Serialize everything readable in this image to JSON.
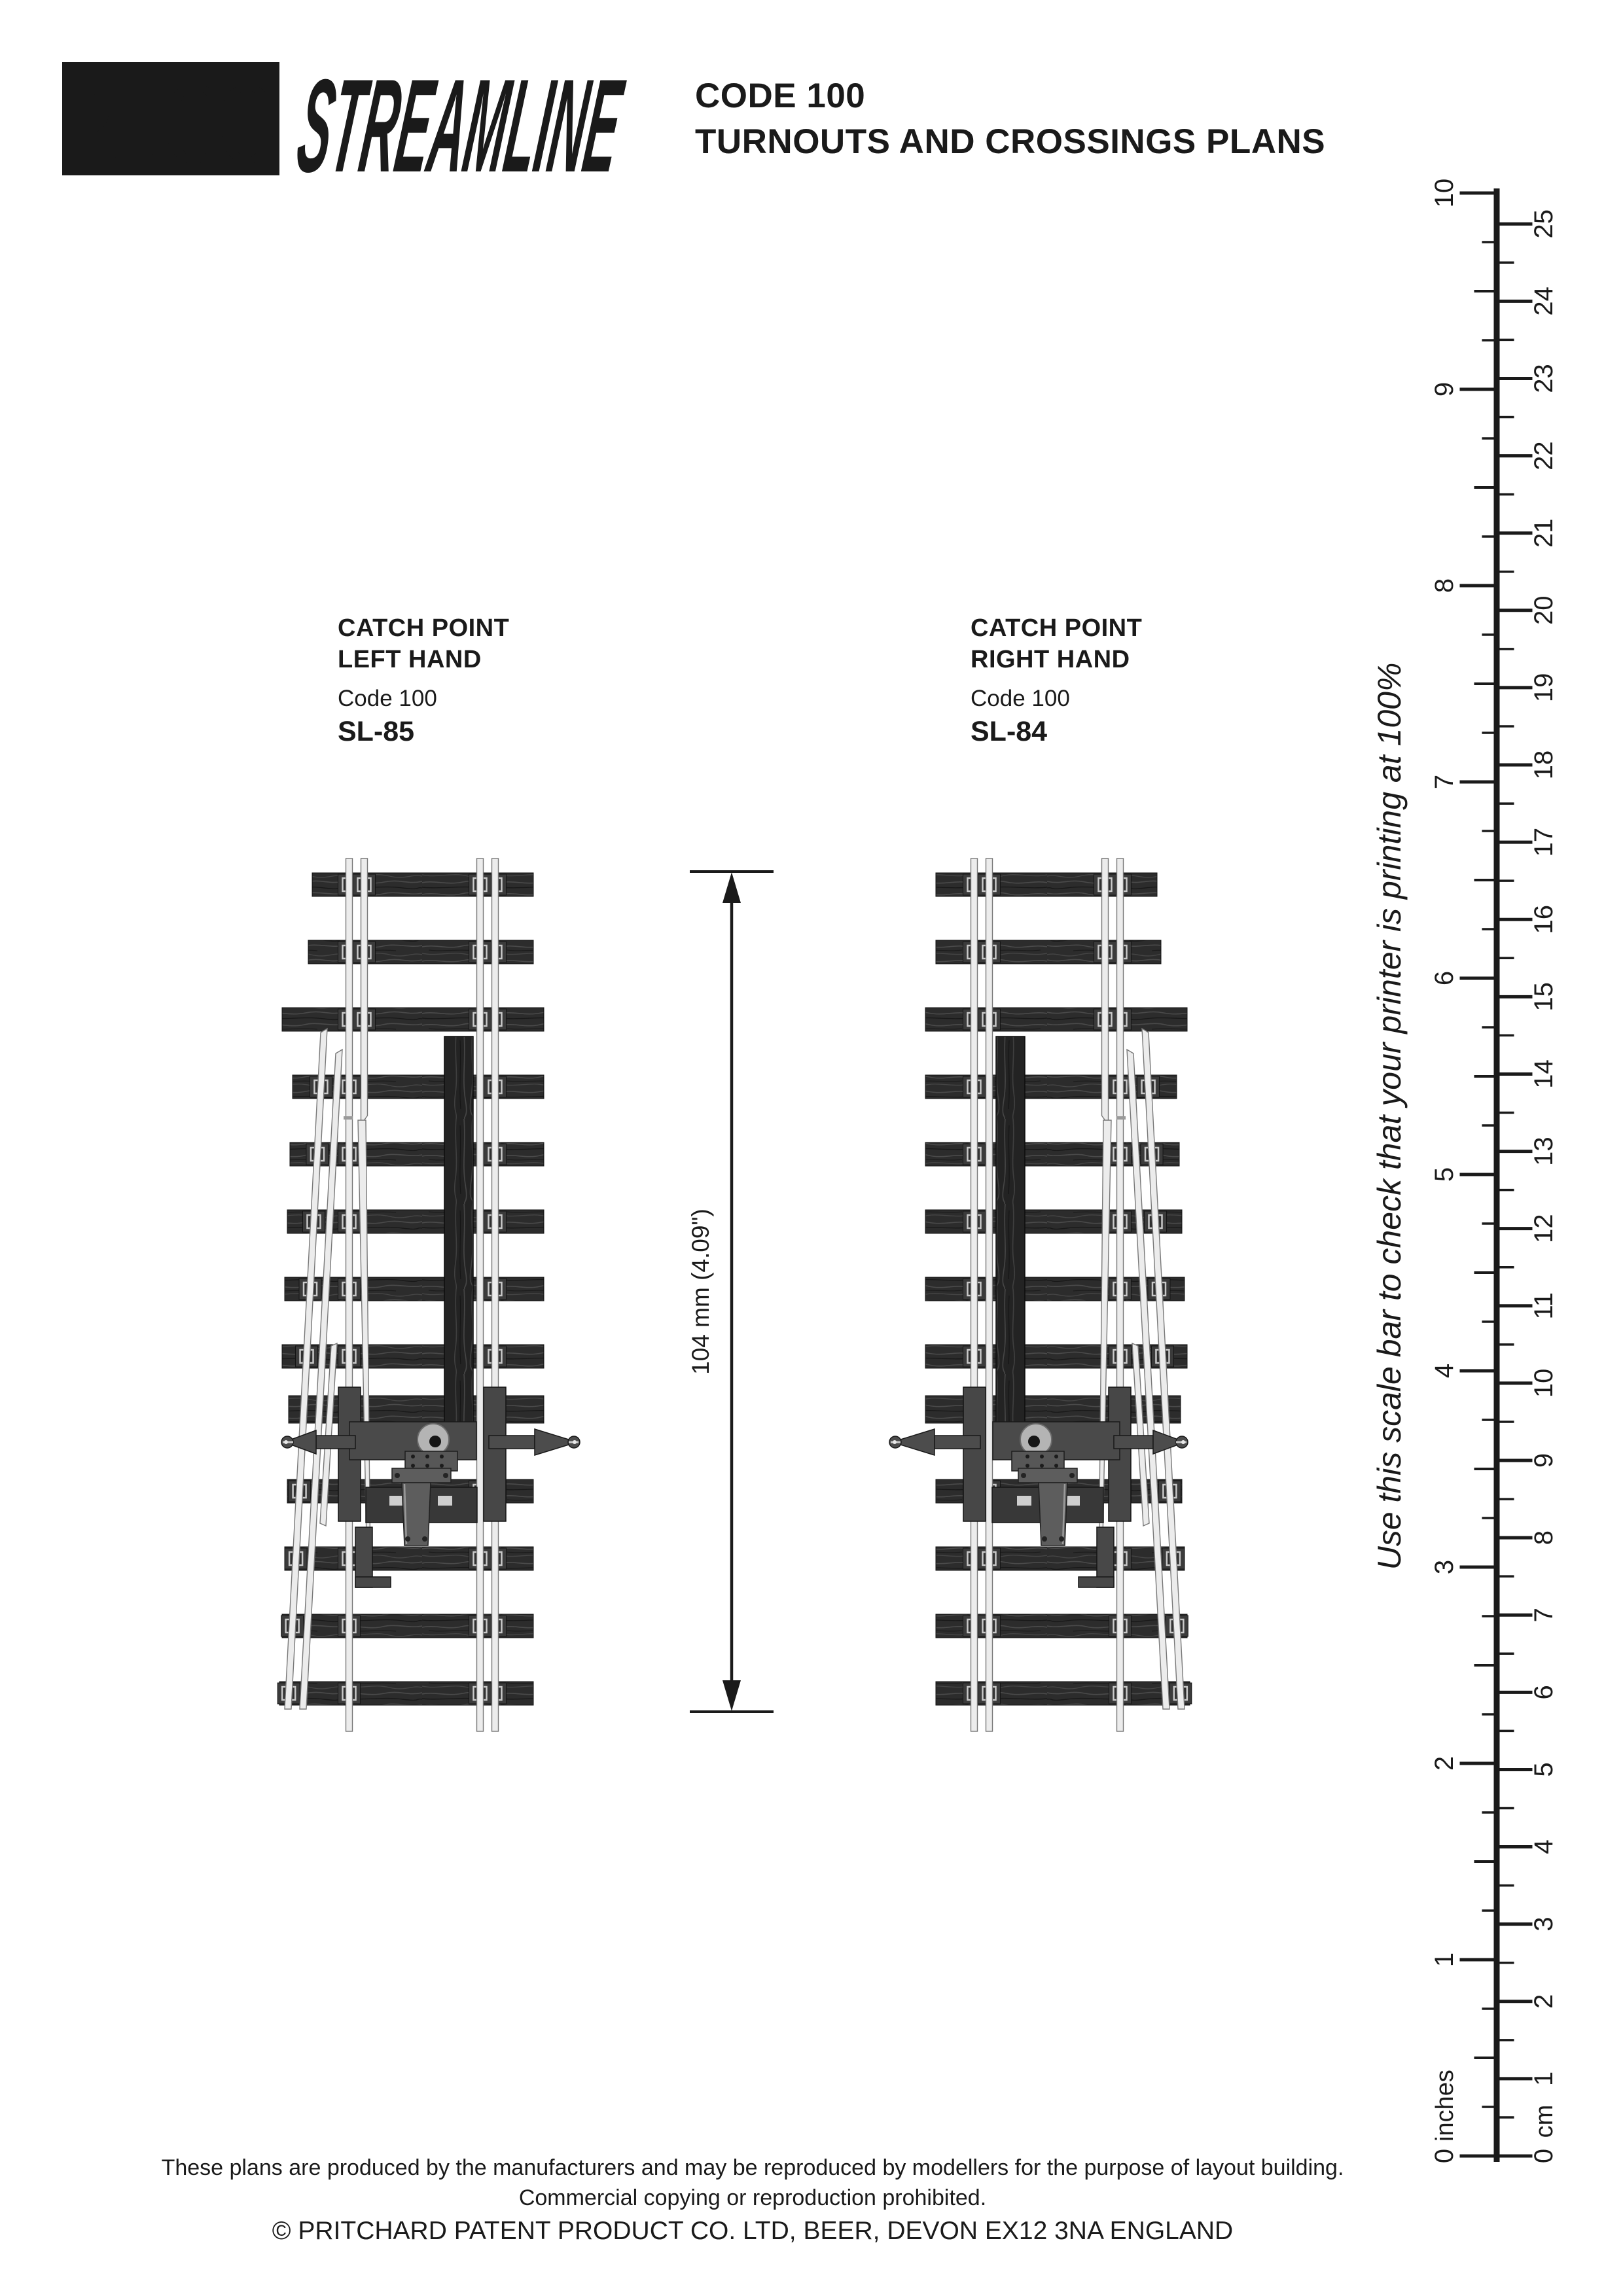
{
  "header": {
    "logo_primary": "PECO",
    "logo_secondary": "STREAMLINE",
    "title_line1": "CODE 100",
    "title_line2": "TURNOUTS AND CROSSINGS PLANS"
  },
  "products": [
    {
      "name_line1": "CATCH POINT",
      "name_line2": "LEFT HAND",
      "code": "Code 100",
      "sku": "SL-85"
    },
    {
      "name_line1": "CATCH POINT",
      "name_line2": "RIGHT HAND",
      "code": "Code 100",
      "sku": "SL-84"
    }
  ],
  "dimension": {
    "label": "104 mm (4.09\")"
  },
  "scale_bar": {
    "instruction": "Use this scale bar to check that your printer is printing at 100%",
    "inches_label": "inches",
    "cm_label": "cm",
    "inch_min": 0,
    "inch_max": 10,
    "cm_min": 0,
    "cm_max": 25
  },
  "footer": {
    "line1": "These plans are produced by the manufacturers and may be reproduced by modellers for the purpose of layout building.",
    "line2": "Commercial copying or reproduction prohibited.",
    "line3": "© PRITCHARD PATENT PRODUCT CO. LTD, BEER, DEVON EX12 3NA ENGLAND"
  },
  "colors": {
    "ink": "#1a1a1a",
    "paper": "#ffffff",
    "sleeper": "#2c2c2c",
    "rail": "#ececec",
    "metal": "#4c4c4c"
  }
}
